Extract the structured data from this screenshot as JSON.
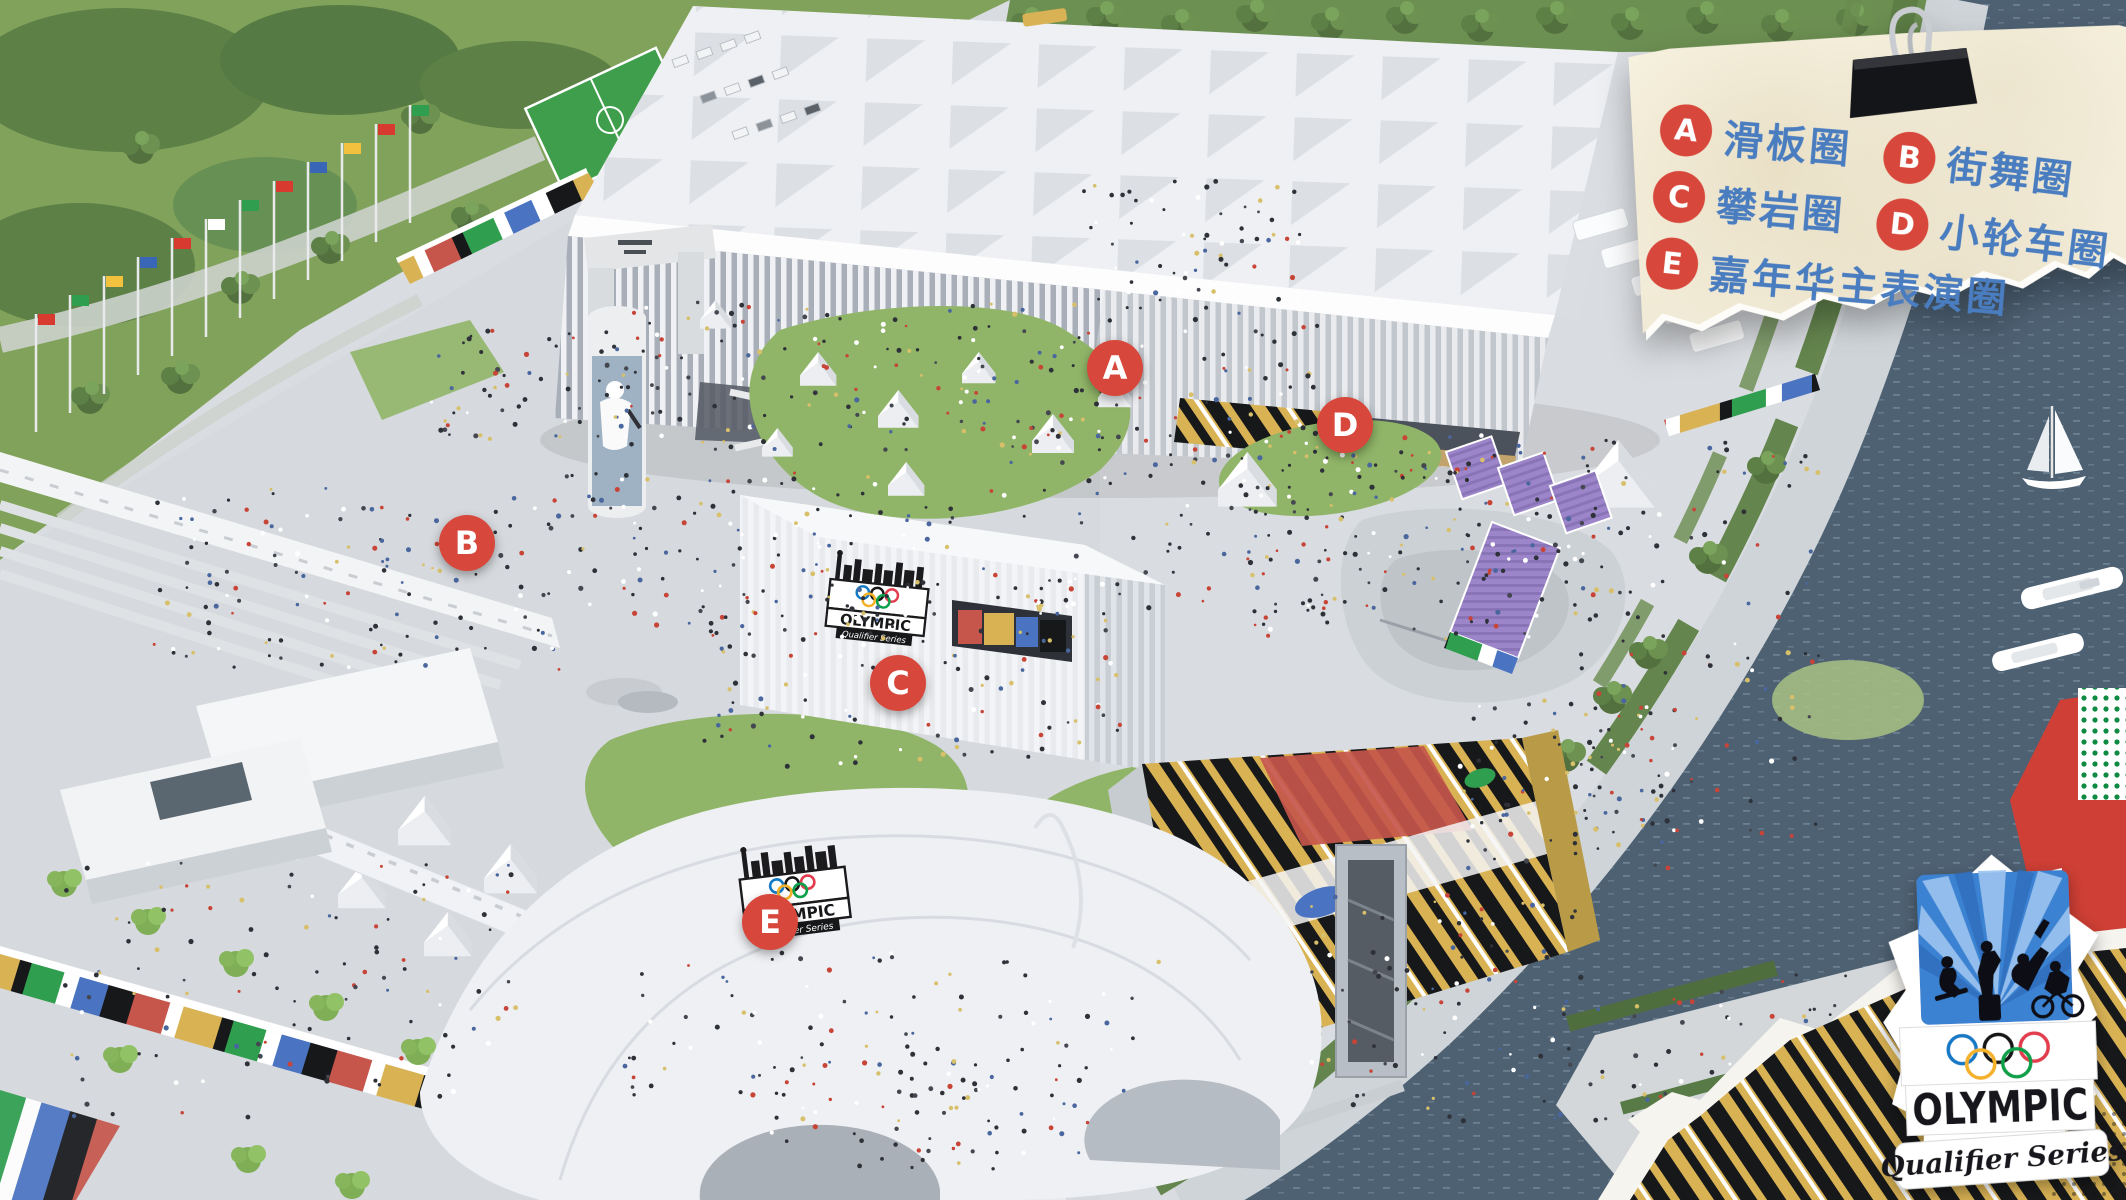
{
  "legend": {
    "items": [
      {
        "letter": "A",
        "label": "滑板圈"
      },
      {
        "letter": "B",
        "label": "街舞圈"
      },
      {
        "letter": "C",
        "label": "攀岩圈"
      },
      {
        "letter": "D",
        "label": "小轮车圈"
      },
      {
        "letter": "E",
        "label": "嘉年华主表演圈"
      }
    ]
  },
  "logo": {
    "title": "OLYMPIC",
    "subtitle": "Qualifier Series"
  },
  "colors": {
    "accent": "#d8473b",
    "legend-text": "#4a7dc0",
    "paper": "#f0e9d4",
    "water": "#4e6173",
    "grass": "#81a25a",
    "lawn": "#90b568",
    "plaza": "#d9dce0",
    "stadium": "#eef0f3",
    "purple": "#9c86c9",
    "graffiti-yellow": "#d9b254",
    "graffiti-red": "#c6564b",
    "graffiti-blue": "#4a74c2",
    "graffiti-green": "#2f9e4f",
    "burst-blue": "#3b82d2",
    "ring-blue": "#1479c5",
    "ring-black": "#151517",
    "ring-red": "#e23d4e",
    "ring-yellow": "#f3b229",
    "ring-green": "#0ba04a"
  }
}
